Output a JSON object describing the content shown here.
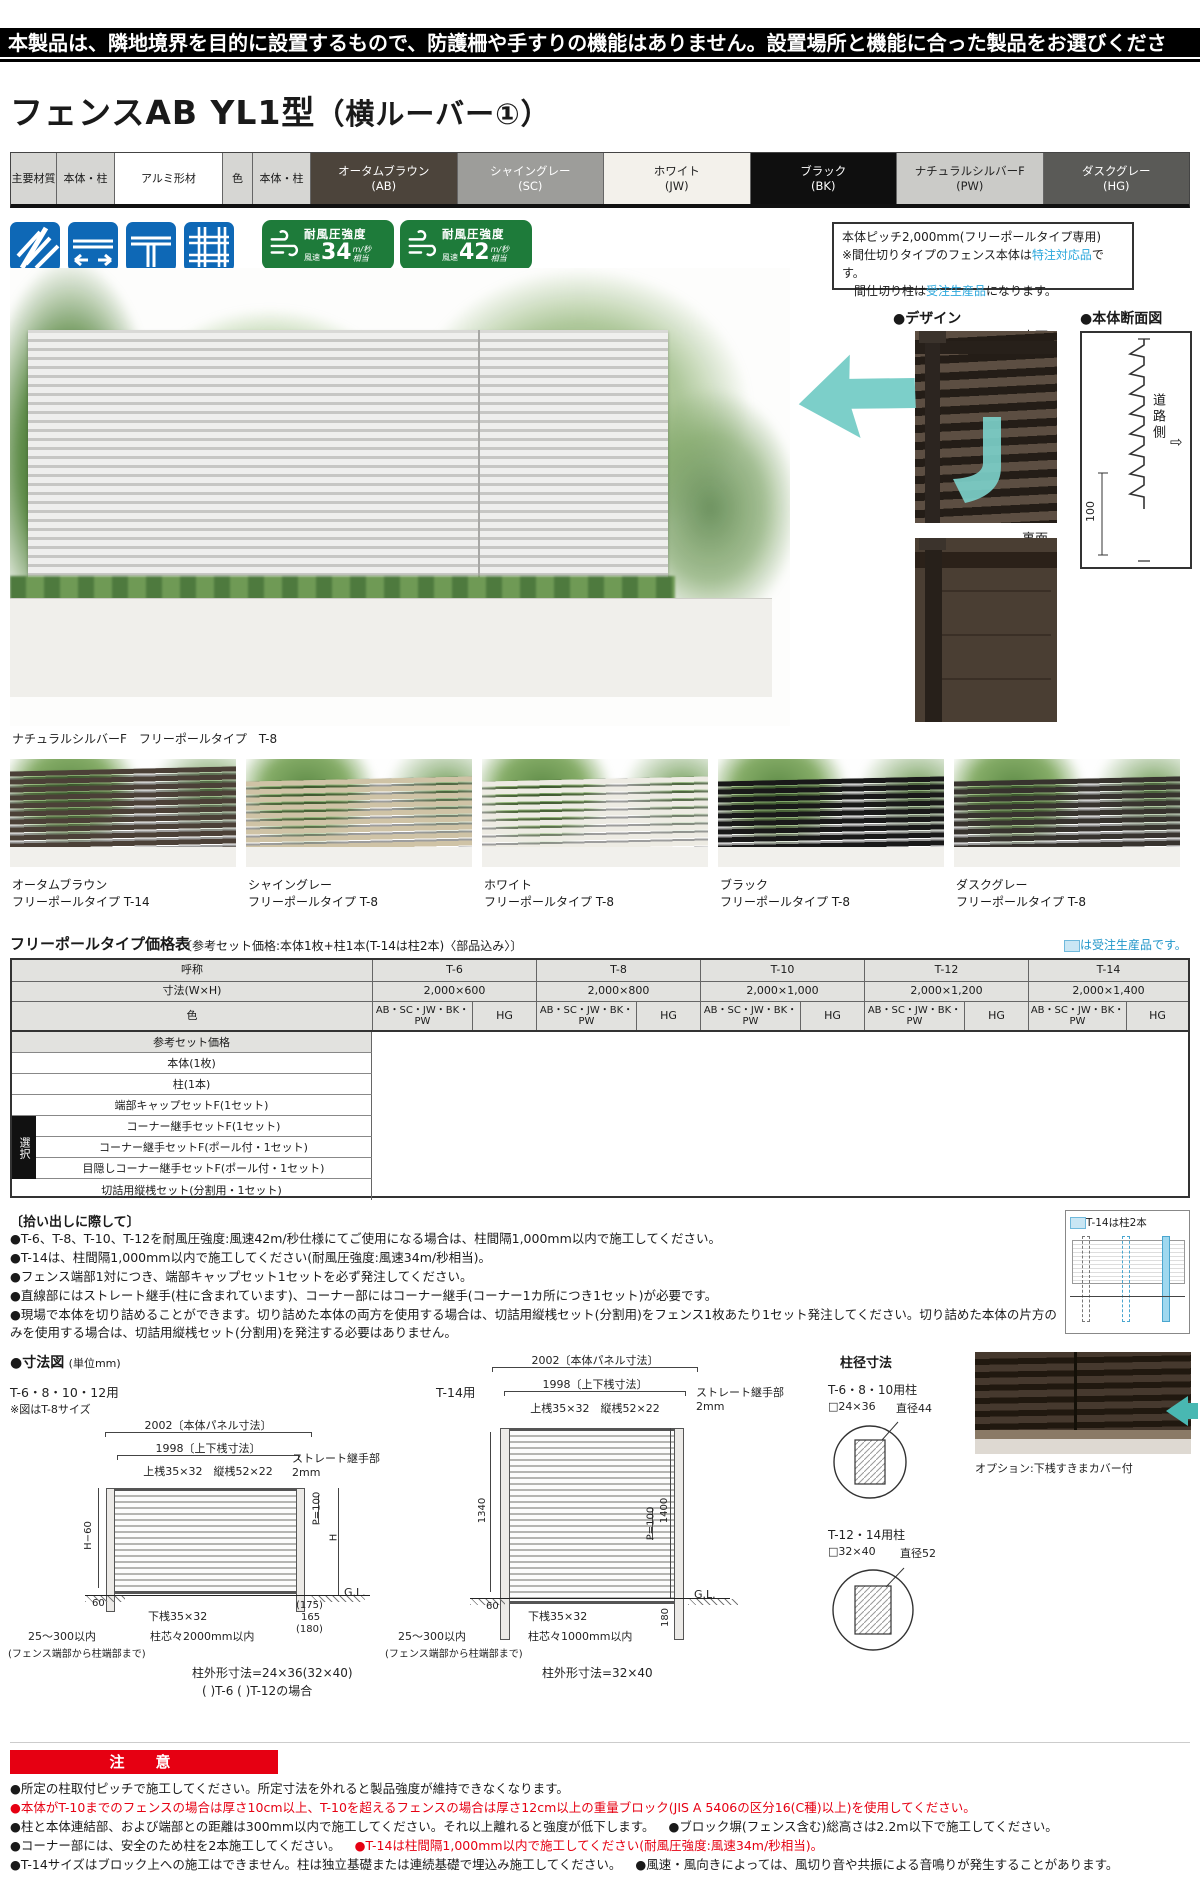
{
  "banner": {
    "text": "本製品は、隣地境界を目的に設置するもので、防護柵や手すりの機能はありません。設置場所と機能に合った製品をお選びください。"
  },
  "title": {
    "main": "フェンスAB YL1型",
    "sub": "（横ルーバー①）"
  },
  "spec": {
    "material_header": "主要材質",
    "scope1": "本体・柱",
    "material": "アルミ形材",
    "color_header": "色",
    "scope2": "本体・柱",
    "colors": [
      {
        "name": "オータムブラウン",
        "code": "(AB)",
        "bg": "#4c443b",
        "fg": "#ffffff"
      },
      {
        "name": "シャイングレー",
        "code": "(SC)",
        "bg": "#9d9d9a",
        "fg": "#ffffff"
      },
      {
        "name": "ホワイト",
        "code": "(JW)",
        "bg": "#f3f1eb",
        "fg": "#222222"
      },
      {
        "name": "ブラック",
        "code": "(BK)",
        "bg": "#0f0f0f",
        "fg": "#ffffff"
      },
      {
        "name": "ナチュラルシルバーF",
        "code": "(PW)",
        "bg": "#cbcbc8",
        "fg": "#222222"
      },
      {
        "name": "ダスクグレー",
        "code": "(HG)",
        "bg": "#5a5a57",
        "fg": "#ffffff"
      }
    ]
  },
  "features": [
    {
      "line1": "片面模様",
      "line2": ""
    },
    {
      "line1": "フリーポール",
      "line2": "(自在柱)"
    },
    {
      "line1": "間仕切り※",
      "line2": "(間柱)"
    },
    {
      "line1": "多段取付",
      "line2": "可能"
    }
  ],
  "wind": {
    "badges": [
      {
        "title": "耐風圧強度",
        "speed_label": "風速",
        "value": "34",
        "unit": "m/秒",
        "unit2": "相当",
        "note": "柱ピッチ2m以下"
      },
      {
        "title": "耐風圧強度",
        "speed_label": "風速",
        "value": "42",
        "unit": "m/秒",
        "unit2": "相当",
        "note": "柱ピッチ1m以下"
      }
    ],
    "note": "※T-14は風速34m/秒相当"
  },
  "info_box": {
    "line1": "本体ピッチ2,000mm(フリーポールタイプ専用)",
    "line2_pre": "※間仕切りタイプのフェンス本体は",
    "line2_em": "特注対応品",
    "line2_post": "です。",
    "line3_pre": "間仕切り柱は",
    "line3_em": "受注生産品",
    "line3_post": "になります。"
  },
  "main_photo": {
    "caption": "ナチュラルシルバーF　フリーポールタイプ　T-8"
  },
  "design": {
    "title": "●デザイン",
    "front": "表面",
    "back": "裏面"
  },
  "section_view": {
    "title": "●本体断面図",
    "road": "道路側",
    "arrow": "⇨",
    "dim": "100"
  },
  "variants": [
    {
      "name": "オータムブラウン",
      "type": "フリーポールタイプ T-14",
      "color": "#4b4037"
    },
    {
      "name": "シャイングレー",
      "type": "フリーポールタイプ T-8",
      "color": "#cfc3a6"
    },
    {
      "name": "ホワイト",
      "type": "フリーポールタイプ T-8",
      "color": "#edebe3"
    },
    {
      "name": "ブラック",
      "type": "フリーポールタイプ T-8",
      "color": "#191919"
    },
    {
      "name": "ダスクグレー",
      "type": "フリーポールタイプ T-8",
      "color": "#37332e"
    }
  ],
  "price": {
    "title": "フリーポールタイプ価格表",
    "subtitle": "〔参考セット価格:本体1枚+柱1本(T-14は柱2本)〈部品込み〉〕",
    "legend": "は受注生産品です。",
    "name_header": "呼称",
    "types": [
      "T-6",
      "T-8",
      "T-10",
      "T-12",
      "T-14"
    ],
    "size_header": "寸法(W×H)",
    "sizes": [
      "2,000×600",
      "2,000×800",
      "2,000×1,000",
      "2,000×1,200",
      "2,000×1,400"
    ],
    "color_header": "色",
    "group_a": "AB・SC・JW・BK・PW",
    "group_b": "HG",
    "select": "選択",
    "rows": [
      "参考セット価格",
      "本体(1枚)",
      "柱(1本)",
      "端部キャップセットF(1セット)",
      "コーナー継手セットF(1セット)",
      "コーナー継手セットF(ポール付・1セット)",
      "目隠しコーナー継手セットF(ポール付・1セット)",
      "切詰用縦桟セット(分割用・1セット)"
    ]
  },
  "pickup": {
    "title": "〔拾い出しに際して〕",
    "items": [
      "●T-6、T-8、T-10、T-12を耐風圧強度:風速42m/秒仕様にてご使用になる場合は、柱間隔1,000mm以内で施工してください。",
      "●T-14は、柱間隔1,000mm以内で施工してください(耐風圧強度:風速34m/秒相当)。",
      "●フェンス端部1対につき、端部キャップセット1セットを必ず発注してください。",
      "●直線部にはストレート継手(柱に含まれています)、コーナー部にはコーナー継手(コーナー1カ所につき1セット)が必要です。",
      "●現場で本体を切り詰めることができます。切り詰めた本体の両方を使用する場合は、切詰用縦桟セット(分割用)をフェンス1枚あたり1セット発注してください。切り詰めた本体の片方のみを使用する場合は、切詰用縦桟セット(分割用)を発注する必要はありません。"
    ]
  },
  "t14_box": {
    "label": "T-14は柱2本"
  },
  "dims": {
    "title": "●寸法図",
    "unit": "(単位mm)",
    "left": {
      "heading": "T-6・8・10・12用",
      "note": "※図はT-8サイズ",
      "panel": "2002〔本体パネル寸法〕",
      "rails": "1998〔上下桟寸法〕",
      "top_rail": "上桟35×32　縦桟52×22",
      "joint1": "ストレート継手部",
      "joint2": "2mm",
      "h_minus": "H−60",
      "p100": "P=100",
      "h": "H",
      "gl": "G.L.",
      "bottom_rail": "下桟35×32",
      "sixty": "60",
      "e1": "(175)",
      "e2": "165",
      "e3": "(180)",
      "range": "25～300以内",
      "range_note": "(フェンス端部から柱端部まで)",
      "pitch": "柱芯々2000mm以内",
      "post": "柱外形寸法=24×36(32×40)",
      "post2": "( )T-6 ( )T-12の場合"
    },
    "mid": {
      "heading": "T-14用",
      "panel": "2002〔本体パネル寸法〕",
      "rails": "1998〔上下桟寸法〕",
      "top_rail": "上桟35×32　縦桟52×22",
      "joint1": "ストレート継手部",
      "joint2": "2mm",
      "v1340": "1340",
      "p100": "P=100",
      "v1400": "1400",
      "gl": "G.L.",
      "bottom_rail": "下桟35×32",
      "sixty": "60",
      "v180": "180",
      "range": "25～300以内",
      "range_note": "(フェンス端部から柱端部まで)",
      "pitch": "柱芯々1000mm以内",
      "post": "柱外形寸法=32×40"
    },
    "posts": {
      "title": "柱径寸法",
      "p1": "T-6・8・10用柱",
      "p1_size": "□24×36",
      "p1_dia": "直径44",
      "p2": "T-12・14用柱",
      "p2_size": "□32×40",
      "p2_dia": "直径52"
    },
    "option": "オプション:下桟すきまカバー付"
  },
  "caution": {
    "title": "注　意",
    "l1": "●所定の柱取付ピッチで施工してください。所定寸法を外れると製品強度が維持できなくなります。",
    "l2": "●本体がT-10までのフェンスの場合は厚さ10cm以上、T-10を超えるフェンスの場合は厚さ12cm以上の重量ブロック(JIS A 5406の区分16(C種)以上)を使用してください。",
    "l3a": "●柱と本体連結部、および端部との距離は300mm以内で施工してください。それ以上離れると強度が低下します。",
    "l3b": "●ブロック塀(フェンス含む)総高さは2.2m以下で施工してください。",
    "l4a": "●コーナー部には、安全のため柱を2本施工してください。",
    "l4b": "●T-14は柱間隔1,000mm以内で施工してください(耐風圧強度:風速34m/秒相当)。",
    "l5a": "●T-14サイズはブロック上への施工はできません。柱は独立基礎または連続基礎で埋込み施工してください。",
    "l5b": "●風速・風向きによっては、風切り音や共振による音鳴りが発生することがあります。"
  }
}
